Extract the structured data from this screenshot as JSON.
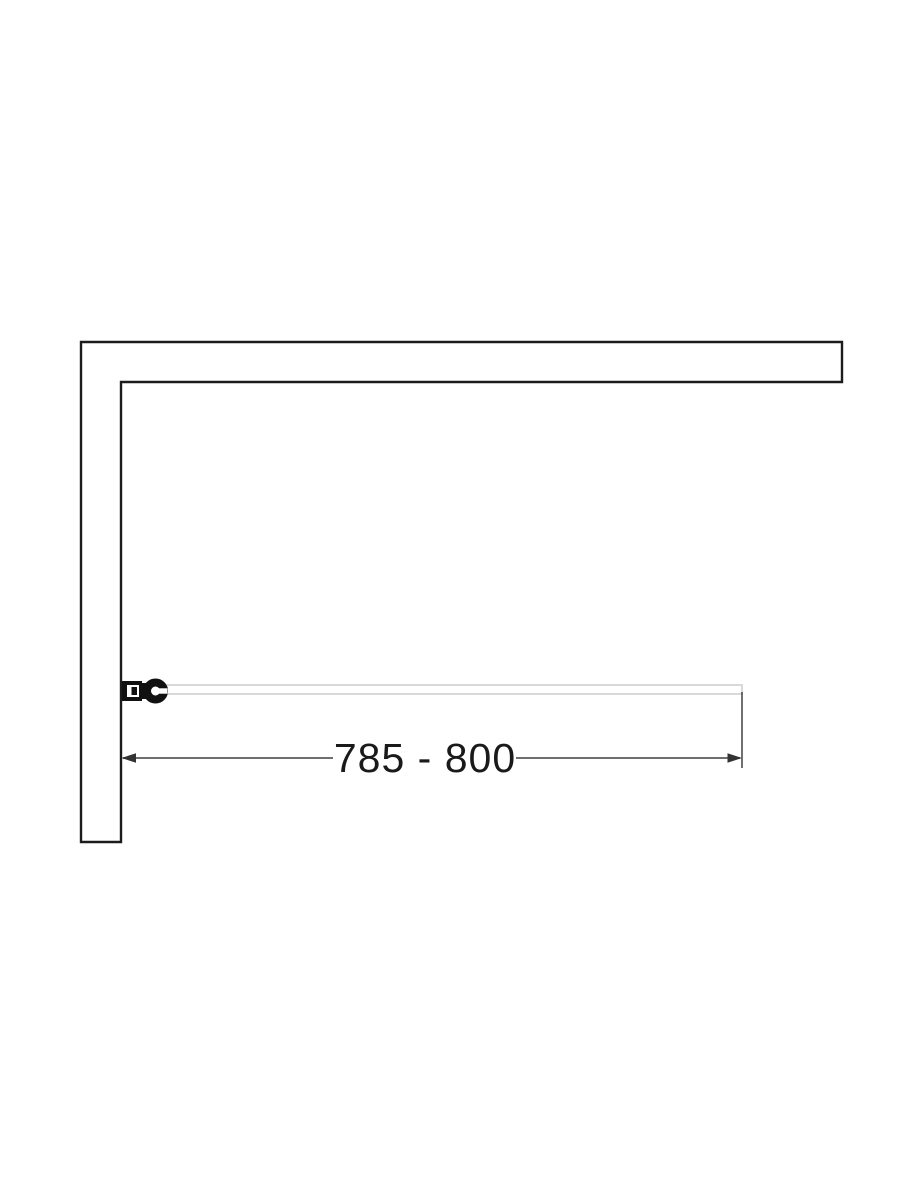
{
  "diagram": {
    "type": "technical-drawing",
    "dimension": {
      "label": "785 - 800"
    },
    "colors": {
      "background": "#ffffff",
      "wall": "#1c1c1c",
      "glass": "#d8d8d8",
      "hinge": "#111111",
      "dimension_line": "#6e6e6e",
      "extension_line": "#4d4d4d",
      "arrow": "#333333",
      "label_text": "#1a1a1a"
    }
  }
}
